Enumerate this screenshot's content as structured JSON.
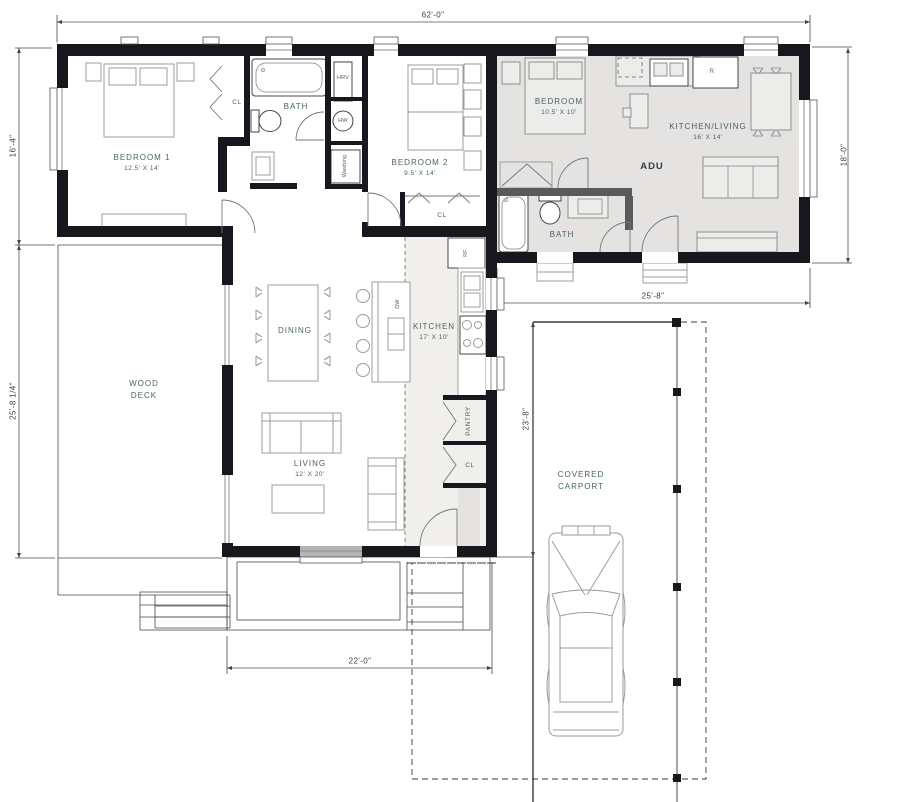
{
  "title": "House + ADU floor plan with wood deck and covered carport",
  "rooms": {
    "bedroom1": {
      "label": "BEDROOM 1",
      "dims": "12.5' X 14'"
    },
    "bedroom1_closet": {
      "label": "CL"
    },
    "main_bath": {
      "label": "BATH"
    },
    "hrv": {
      "label": "HRV"
    },
    "hot_water": {
      "label": "HW"
    },
    "washing": {
      "label": "Washing"
    },
    "bedroom2": {
      "label": "BEDROOM 2",
      "dims": "9.5' X 14'"
    },
    "bedroom2_closet": {
      "label": "CL"
    },
    "fridge_main": {
      "label": "RF"
    },
    "kitchen": {
      "label": "KITCHEN",
      "dims": "17' X 10'"
    },
    "dishwasher": {
      "label": "DW"
    },
    "dining": {
      "label": "DINING"
    },
    "wood_deck": {
      "label": "WOOD DECK"
    },
    "living": {
      "label": "LIVING",
      "dims": "12' X 20'"
    },
    "pantry": {
      "label": "PANTRY"
    },
    "hall_closet": {
      "label": "CL"
    },
    "adu": {
      "label": "ADU"
    },
    "adu_bedroom": {
      "label": "BEDROOM",
      "dims": "10.5' X 10'"
    },
    "adu_bath": {
      "label": "BATH"
    },
    "adu_kitchen_living": {
      "label": "KITCHEN/LIVING",
      "dims": "16' X 14'"
    },
    "adu_fridge": {
      "label": "R"
    },
    "carport": {
      "label": "COVERED CARPORT"
    }
  },
  "dimensions": {
    "overall_width": "62'-0\"",
    "left_upper": "16'-4\"",
    "left_lower": "25'-8 1/4\"",
    "adu_height": "18'-0\"",
    "adu_width": "25'-8\"",
    "carport_depth": "23'-8\"",
    "entry_porch_width": "22'-0\""
  },
  "colors": {
    "wall_color": "#17171d",
    "interior_gray_wall": "#5a5a5a",
    "adu_floor": "#e4e3e1",
    "kitchen_floor": "#f0efec",
    "label_color": "#4a635c",
    "dimension_text": "#3c3c3c",
    "furniture_line": "#9c9c9c",
    "site_line": "#3a3a3a"
  }
}
